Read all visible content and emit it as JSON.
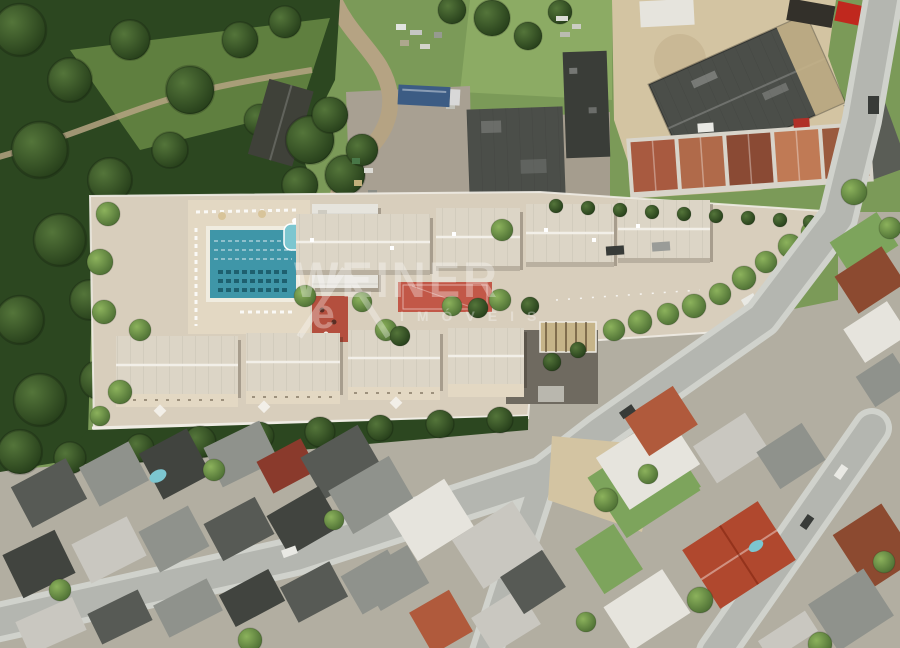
{
  "watermark": {
    "brand": "WEINER",
    "subtitle": "IMÓVEIS",
    "logo_letter": "e",
    "color": "#ffffff",
    "opacity": "0.32"
  },
  "palette": {
    "grass": "#7b9a58",
    "grass_light": "#8cab64",
    "clearing": "#5f7f3f",
    "forest": "#2c4720",
    "ground": "#b2aea1",
    "lawn": "#7da45c",
    "dirt": "#b5a383",
    "sand": "#d3c4a2",
    "gravel": "#a8a092",
    "warehouse": "#4b4e49",
    "warehouse_dark": "#3a3d38",
    "straw": "#c6b489",
    "pavement": "#d8cebc",
    "deck": "#e3d8c3",
    "wall": "#efece4",
    "roof": "#dcd5c6",
    "roof_ridge": "#f2efe8",
    "pool": "#3f96a8",
    "pool_lane": "#1e606f",
    "kids_pool": "#7cc6d0",
    "court": "#c25848",
    "playground": "#b44f3e",
    "street": "#b4b6b0",
    "sidewalk": "#d0d2cc",
    "white_roof": "#e6e4dd",
    "light_roof": "#c9c7c0",
    "mid_roof": "#8f928c",
    "dark_roof": "#575a55",
    "darker_roof": "#41443f",
    "terracotta": "#b05a3c",
    "rust": "#8c4a30",
    "red_roof": "#b0482e",
    "dark_red": "#8a3a2c",
    "truck_red": "#c0281e",
    "truck_blue": "#3c5c84",
    "watermark": "#ffffff"
  }
}
